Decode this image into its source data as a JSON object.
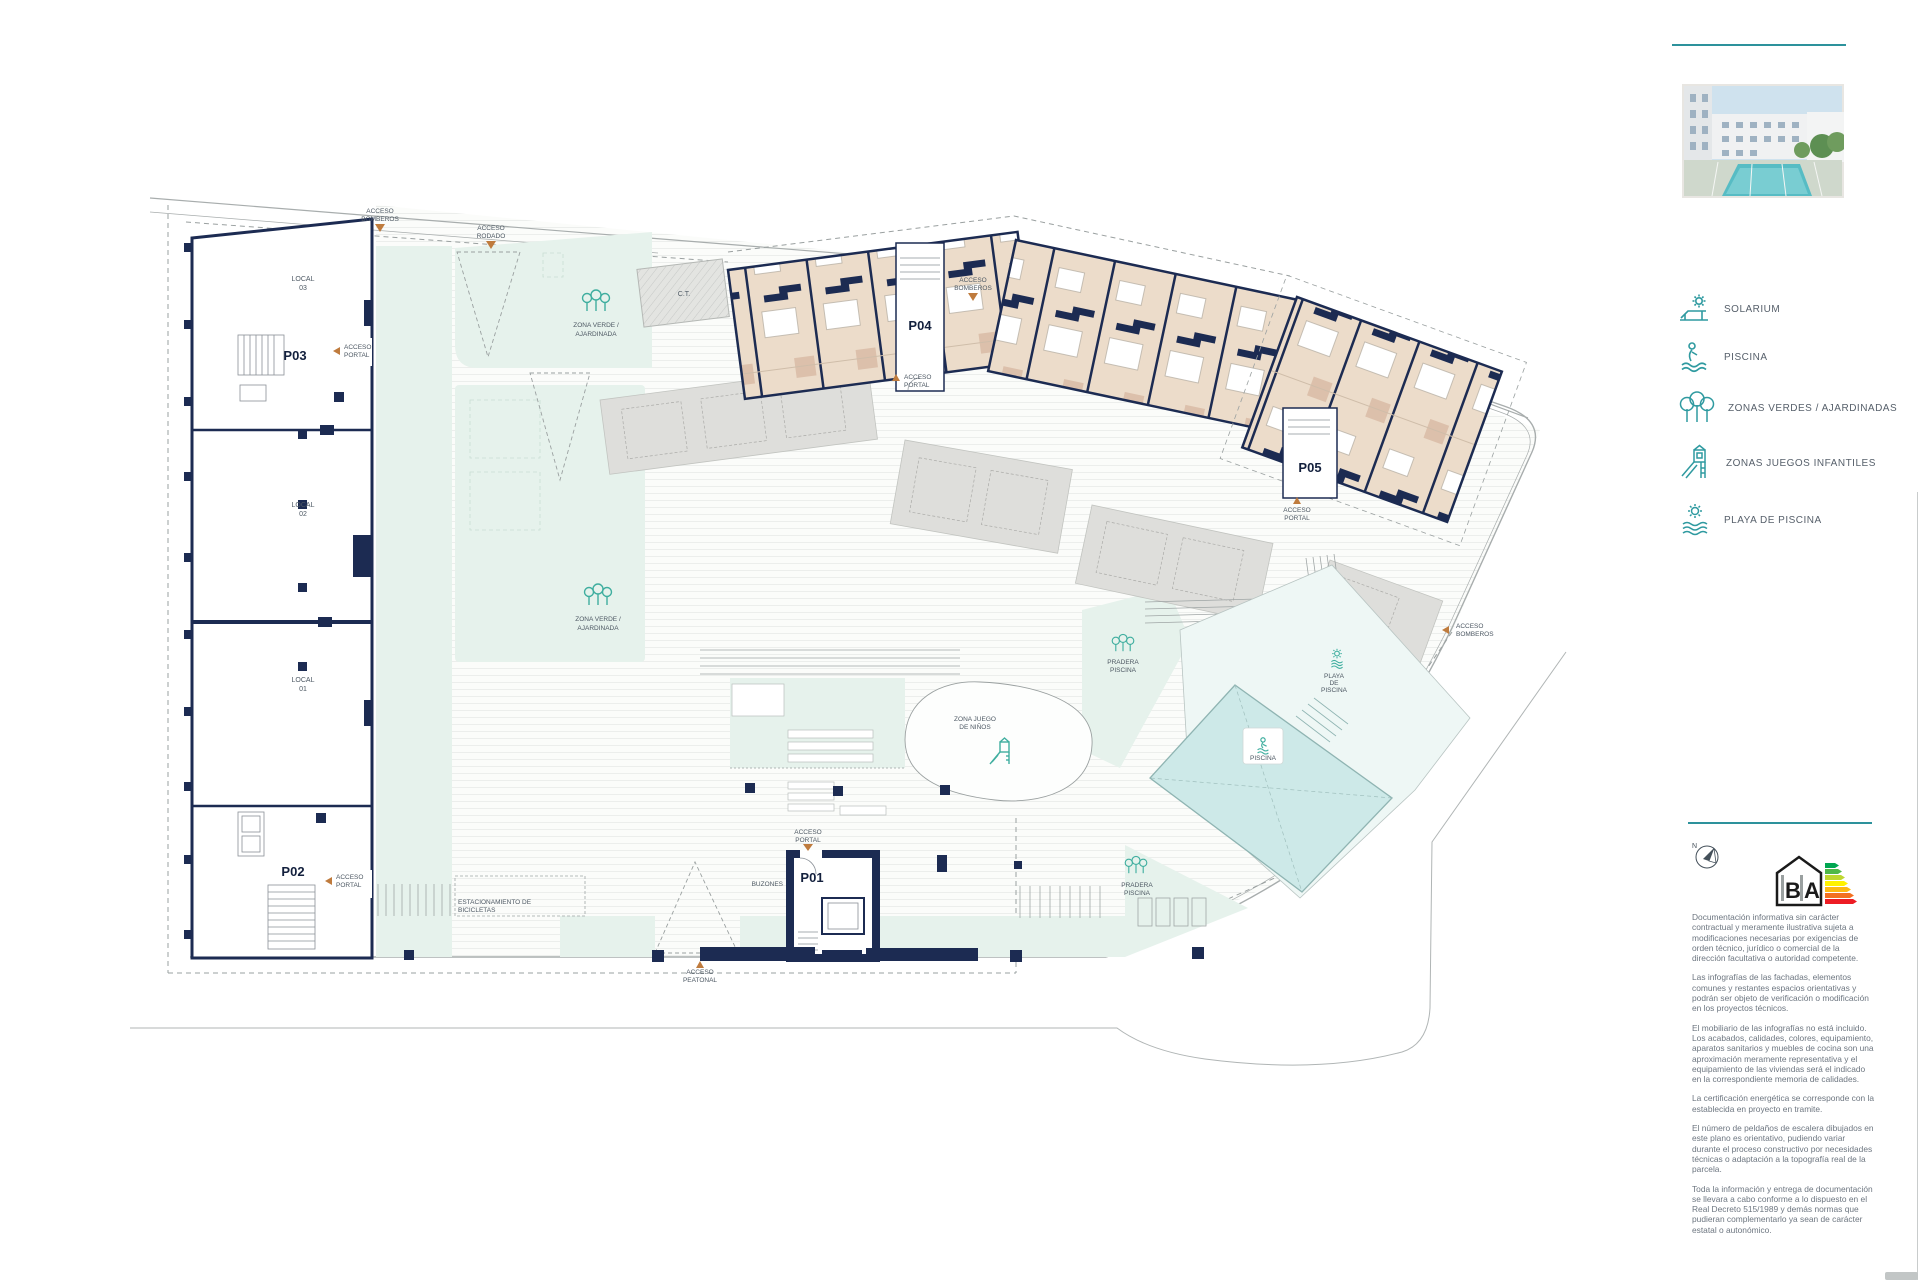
{
  "plan": {
    "portals": {
      "p01": "P01",
      "p02": "P02",
      "p03": "P03",
      "p04": "P04",
      "p05": "P05"
    },
    "locals": {
      "l03": [
        "LOCAL",
        "03"
      ],
      "l02": [
        "LOCAL",
        "02"
      ],
      "l01": [
        "LOCAL",
        "01"
      ]
    },
    "ct": "C.T.",
    "buzones": "BUZONES",
    "accesos": {
      "bomberos": [
        "ACCESO",
        "BOMBEROS"
      ],
      "rodado": [
        "ACCESO",
        "RODADO"
      ],
      "peatonal": [
        "ACCESO",
        "PEATONAL"
      ],
      "portal": [
        "ACCESO",
        "PORTAL"
      ]
    },
    "zonas": {
      "zona_verde": [
        "ZONA VERDE /",
        "AJARDINADA"
      ],
      "zona_juego": [
        "ZONA JUEGO",
        "DE NIÑOS"
      ],
      "pradera": [
        "PRADERA",
        "PISCINA"
      ],
      "playa": [
        "PLAYA",
        "DE",
        "PISCINA"
      ],
      "piscina": "PISCINA",
      "bicicletas": [
        "ESTACIONAMIENTO DE",
        "BICICLETAS"
      ]
    }
  },
  "sidebar": {
    "legend": [
      {
        "icon": "solarium-icon",
        "label": "SOLARIUM"
      },
      {
        "icon": "piscina-icon",
        "label": "PISCINA"
      },
      {
        "icon": "zonas-verdes-icon",
        "label": "ZONAS VERDES / AJARDINADAS"
      },
      {
        "icon": "juegos-infantiles-icon",
        "label": "ZONAS JUEGOS INFANTILES"
      },
      {
        "icon": "playa-piscina-icon",
        "label": "PLAYA DE PISCINA"
      }
    ],
    "compass_n": "N",
    "energy": {
      "letter_b": "B",
      "letter_a": "A"
    },
    "disclaimer": [
      "Documentación informativa sin carácter contractual y meramente ilustrativa sujeta a modificaciones necesarias por exigencias de orden técnico, jurídico o comercial de la dirección facultativa o autoridad competente.",
      "Las infografías de las fachadas, elementos comunes y restantes espacios orientativas y podrán ser objeto de verificación o modificación en los proyectos técnicos.",
      "El mobiliario de las infografías no está incluido. Los acabados, calidades, colores, equipamiento, aparatos sanitarios y muebles de cocina son una aproximación meramente representativa y el equipamiento de las viviendas será el indicado en la correspondiente memoria de calidades.",
      "La certificación energética se corresponde con la establecida en proyecto en tramite.",
      "El número de peldaños de escalera dibujados en este plano es orientativo, pudiendo variar durante el proceso constructivo por necesidades técnicas o adaptación a la topografía real de la parcela.",
      "Toda la información y entrega de documentación se llevara a cabo conforme a lo dispuesto en el Real Decreto 515/1989 y demás normas que pudieran complementarlo ya sean de carácter estatal o autonómico."
    ]
  },
  "colors": {
    "teal": "#2d929c",
    "icon_teal": "#2f9aa0",
    "wall_navy": "#1c2b52",
    "room_beige": "#ecdcca",
    "green": "#e6f2ec",
    "pool": "#cde9e8",
    "accent_orange": "#bf7b3d"
  }
}
